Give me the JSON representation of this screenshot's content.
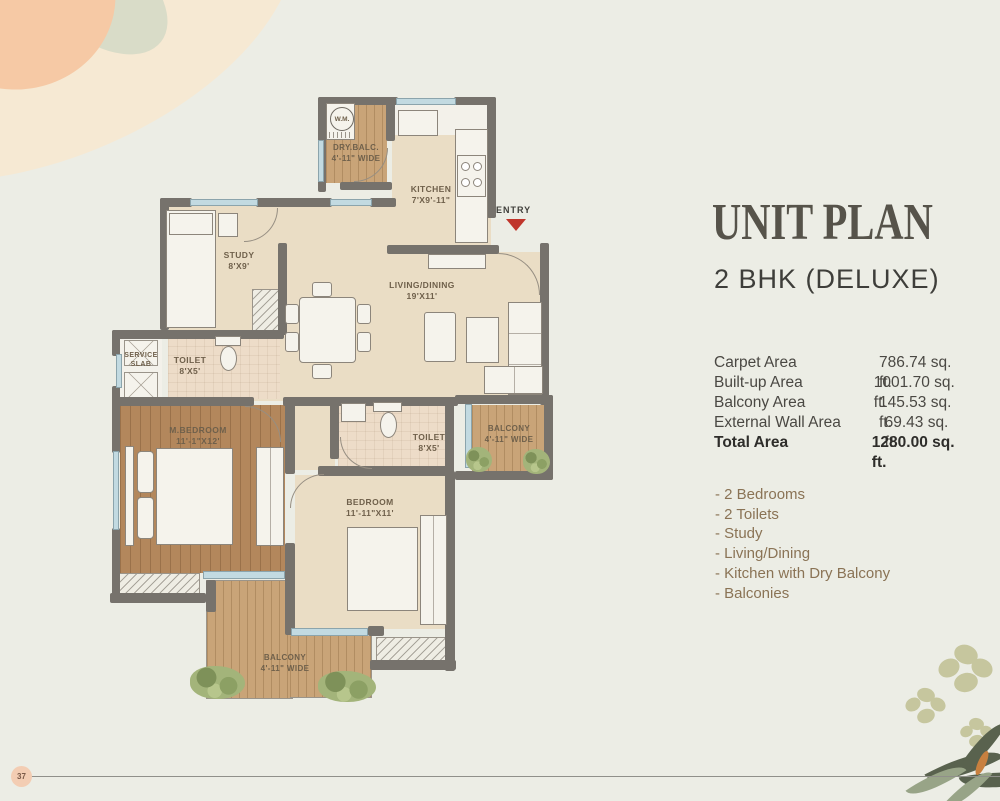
{
  "page": {
    "badge": "37"
  },
  "panel": {
    "title": "UNIT PLAN",
    "subtitle": "2 BHK (DELUXE)",
    "areas": [
      {
        "label": "Carpet Area",
        "value": "786.74  sq. ft."
      },
      {
        "label": "Built-up Area",
        "value": "1001.70 sq. ft."
      },
      {
        "label": "Balcony Area",
        "value": "145.53 sq. ft."
      },
      {
        "label": "External Wall Area",
        "value": "69.43 sq. ft."
      },
      {
        "label": "Total Area",
        "value": "1280.00 sq. ft."
      }
    ],
    "features": [
      "- 2 Bedrooms",
      "- 2 Toilets",
      "- Study",
      "- Living/Dining",
      "- Kitchen with Dry Balcony",
      "- Balconies"
    ]
  },
  "plan": {
    "entry": "ENTRY",
    "wm": "W.M.",
    "dry_balc": {
      "name": "DRY.BALC.",
      "dim": "4'-11\" WIDE"
    },
    "kitchen": {
      "name": "KITCHEN",
      "dim": "7'X9'-11\""
    },
    "study": {
      "name": "STUDY",
      "dim": "8'X9'"
    },
    "living": {
      "name": "LIVING/DINING",
      "dim": "19'X11'"
    },
    "service": {
      "name": "SERVICE",
      "dim": "SLAB"
    },
    "toilet1": {
      "name": "TOILET",
      "dim": "8'X5'"
    },
    "toilet2": {
      "name": "TOILET",
      "dim": "8'X5'"
    },
    "mbedroom": {
      "name": "M.BEDROOM",
      "dim": "11'-1\"X12'"
    },
    "bedroom": {
      "name": "BEDROOM",
      "dim": "11'-11\"X11'"
    },
    "balcony_right": {
      "name": "BALCONY",
      "dim": "4'-11\" WIDE"
    },
    "balcony_bottom": {
      "name": "BALCONY",
      "dim": "4'-11\" WIDE"
    }
  }
}
